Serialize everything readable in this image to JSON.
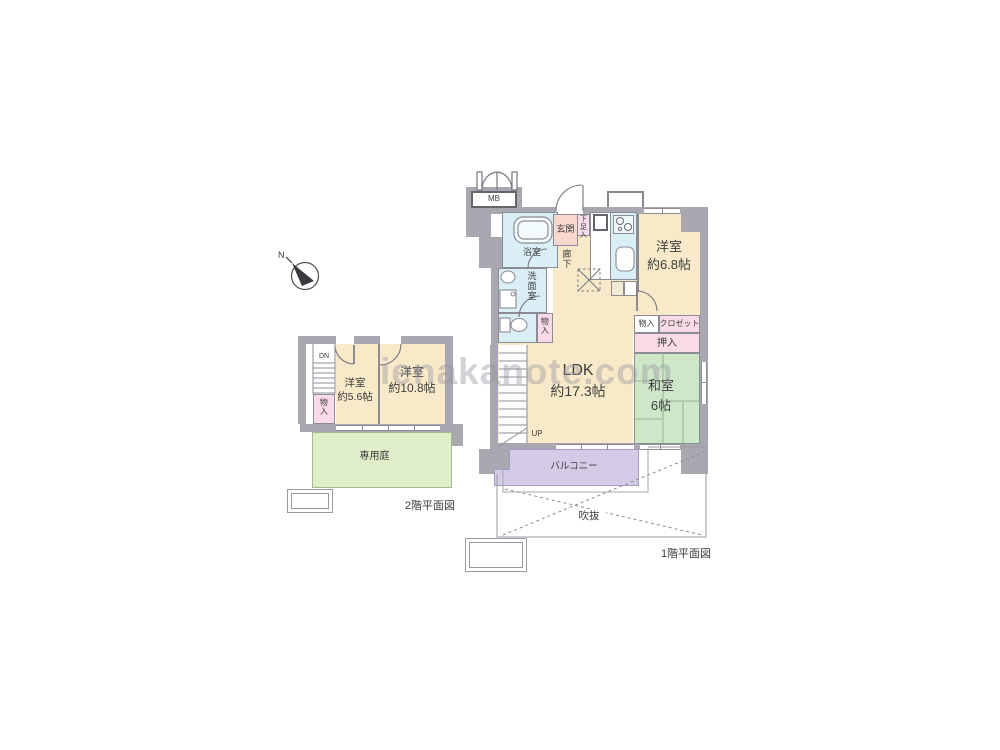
{
  "watermark": "ienakanote.com",
  "compass": {
    "north": "N"
  },
  "colors": {
    "wall": "#a9a8b0",
    "line": "#8d8c94",
    "room": "#f8e9c8",
    "pink": "#f9dbe7",
    "salmon": "#f8d8cd",
    "blue": "#daeef6",
    "tatami": "#cde7c8",
    "garden": "#dfeec9",
    "balcony": "#d4cce6",
    "text": "#3c3c3e",
    "watermark": "rgba(150,150,160,0.42)"
  },
  "floor1": {
    "title": "1階平面図",
    "meter_box": "MB",
    "genkan": "玄関",
    "shoe_box": "下足入",
    "bath": "浴室",
    "washroom": "洗面室",
    "hallway": "廊下",
    "toilet_storage": "物入",
    "western_room": {
      "name": "洋室",
      "size": "約6.8帖"
    },
    "storage": "物入",
    "closet": "クロゼット",
    "oshiire": "押入",
    "japanese_room": {
      "name": "和室",
      "size": "6帖"
    },
    "ldk": {
      "name": "LDK",
      "size": "約17.3帖"
    },
    "stairs_up": "UP",
    "balcony": "バルコニー",
    "void": "吹抜"
  },
  "floor2": {
    "title": "2階平面図",
    "stairs_down": "DN",
    "storage": "物入",
    "western_room_small": {
      "name": "洋室",
      "size": "約5.6帖"
    },
    "western_room_large": {
      "name": "洋室",
      "size": "約10.8帖"
    },
    "garden": "専用庭"
  }
}
